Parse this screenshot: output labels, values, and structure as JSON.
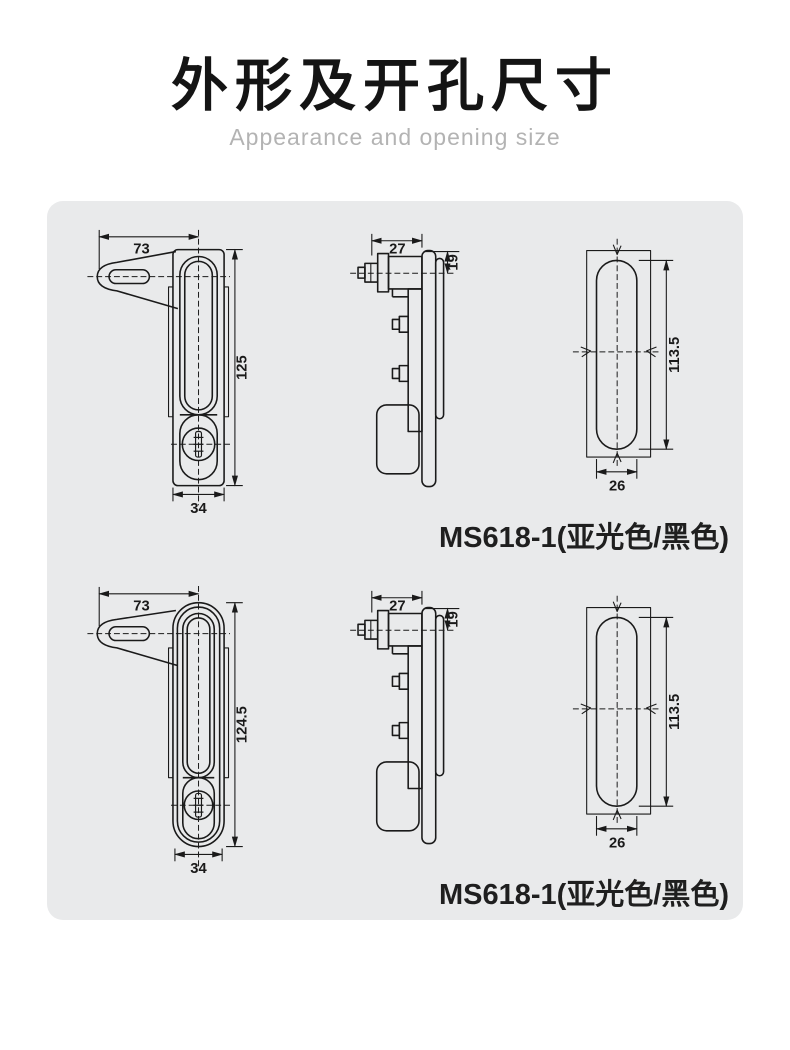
{
  "page": {
    "title": "外形及开孔尺寸",
    "subtitle": "Appearance and opening size"
  },
  "colors": {
    "panel_background": "#e9eaeb",
    "drawing_line": "#1a1a1a",
    "title_text": "#141414",
    "subtitle_text": "#b3b3b3",
    "label_text": "#1f1f1f"
  },
  "panel": {
    "rows": [
      {
        "label": "MS618-1(亚光色/黑色)",
        "front_view": {
          "handle_width": "73",
          "body_height": "125",
          "body_width": "34"
        },
        "side_view": {
          "cylinder_width": "27",
          "protrusion_depth": "19"
        },
        "cutout_view": {
          "hole_height": "113.5",
          "hole_width": "26"
        }
      },
      {
        "label": "MS618-1(亚光色/黑色)",
        "front_view": {
          "handle_width": "73",
          "body_height": "124.5",
          "body_width": "34"
        },
        "side_view": {
          "cylinder_width": "27",
          "protrusion_depth": "19"
        },
        "cutout_view": {
          "hole_height": "113.5",
          "hole_width": "26"
        }
      }
    ]
  }
}
